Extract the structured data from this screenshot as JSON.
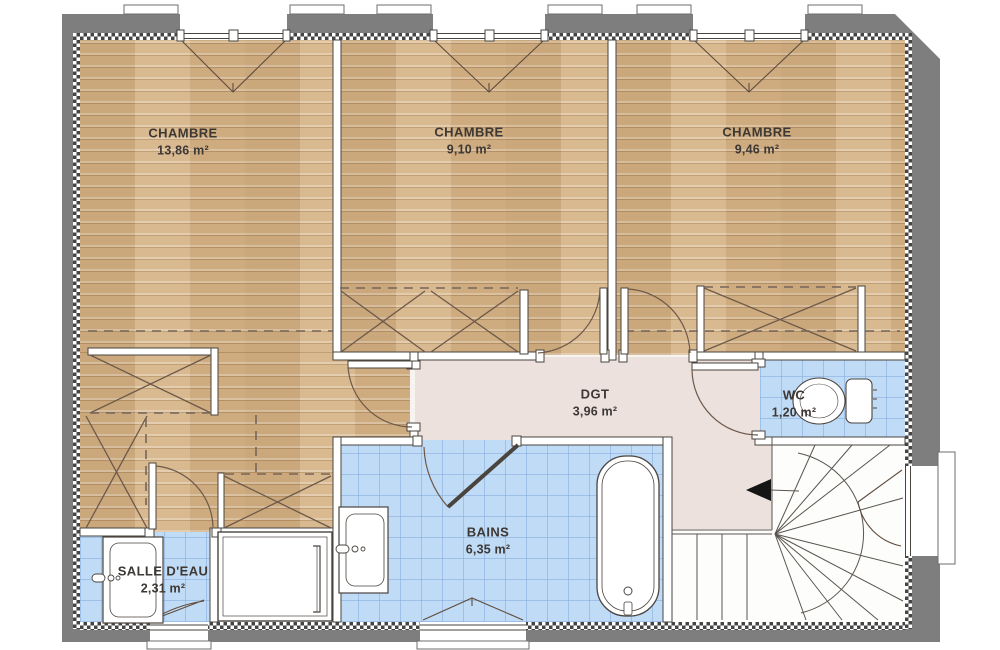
{
  "plan": {
    "type": "floor-plan",
    "floor": "étage",
    "rooms": [
      {
        "id": "chambre1",
        "name": "CHAMBRE",
        "area": "13,86 m²"
      },
      {
        "id": "chambre2",
        "name": "CHAMBRE",
        "area": "9,10 m²"
      },
      {
        "id": "chambre3",
        "name": "CHAMBRE",
        "area": "9,46 m²"
      },
      {
        "id": "dgt",
        "name": "DGT",
        "area": "3,96 m²"
      },
      {
        "id": "wc",
        "name": "WC",
        "area": "1,20 m²"
      },
      {
        "id": "bains",
        "name": "BAINS",
        "area": "6,35 m²"
      },
      {
        "id": "salledeau",
        "name": "SALLE D'EAU",
        "area": "2,31 m²"
      }
    ],
    "colors": {
      "wood_floor": "#d5b183",
      "tile_floor": "#c0dbf6",
      "hallway_floor": "#ece1dd",
      "exterior_wall": "#7e7e7e",
      "lines": "#4a443f"
    },
    "fixtures": [
      "bathtub",
      "washbasin",
      "shower",
      "toilet",
      "winder-staircase",
      "closets",
      "windows",
      "doors"
    ]
  }
}
